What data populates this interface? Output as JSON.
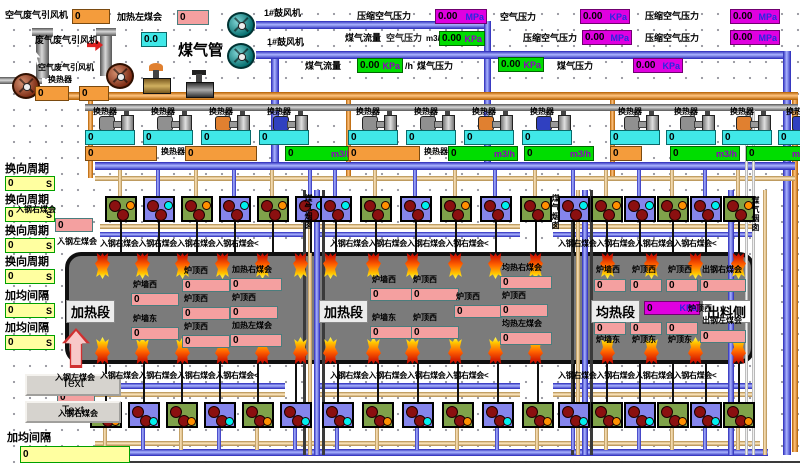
{
  "colors": {
    "magenta_box": "#E000E0",
    "green_box": "#00DD00",
    "cyan_box": "#40E8E8",
    "orange_box": "#F49C3C",
    "pink_box": "#F4A0A0",
    "yellow_box": "#FFFFA0",
    "furnace": "#7b7b7b"
  },
  "top": {
    "fan1_label": "空气废气引风机",
    "fan1_value": "0",
    "heat_left_label": "加热左煤会",
    "heat_left_value": "0",
    "blower_labels": [
      "1#鼓风机",
      "1#鼓风机"
    ],
    "row1_readouts": [
      {
        "label": "压缩空气压力",
        "value": "0.00",
        "unit": "MPa"
      },
      {
        "label": "空气压力",
        "value": "0.00",
        "unit": "KPa"
      },
      {
        "label": "压缩空气压力",
        "value": "0.00",
        "unit": "MPa"
      }
    ],
    "exhaust_fan_label": "废气废气引风机",
    "exhaust_fan_value": "0.0",
    "gas_pipe_label": "煤气管",
    "gas_flow_label": "煤气流量",
    "gas_flow_overlay": "空气压力",
    "gas_flow_overlay2": "m3/",
    "gas_flow_value": "0.00",
    "gas_flow_unit": "KPa",
    "row2_readouts": [
      {
        "label": "压缩空气压力",
        "value": "0.00",
        "unit": "MPa"
      },
      {
        "label": "压缩空气压力",
        "value": "0.00",
        "unit": "MPa"
      }
    ],
    "fan2_label": "空气废气引风机",
    "fan2_sub": "换热器",
    "row3": {
      "gas_flow_label": "煤气流量",
      "gas_flow_value": "0.00",
      "gas_flow_unit": "KPa",
      "per_hour": "/h",
      "gas_pressure_a_label": "煤气压力",
      "gas_pressure_a_value": "0.00",
      "gas_pressure_a_unit": "KPa",
      "gas_pressure_b_label": "煤气压力",
      "gas_pressure_b_value": "0.00",
      "gas_pressure_b_unit": "KPa"
    },
    "left_fan_values": [
      "0",
      "0"
    ]
  },
  "valve_row": {
    "unit_label": "换热器",
    "groups": [
      {
        "cyan_values": [
          "0",
          "0",
          "0",
          "0"
        ],
        "bottom": [
          {
            "type": "orange",
            "value": "0"
          },
          {
            "type": "orange",
            "value": "0"
          },
          {
            "type": "flow",
            "value": "0",
            "unit": "m3/h"
          }
        ]
      },
      {
        "cyan_values": [
          "0",
          "0",
          "0",
          "0"
        ],
        "bottom": [
          {
            "type": "orange",
            "value": "0"
          },
          {
            "type": "flow",
            "value": "0",
            "unit": "m3/h"
          },
          {
            "type": "flow",
            "value": "0",
            "unit": "m3/h"
          }
        ]
      },
      {
        "cyan_values": [
          "0",
          "0",
          "0",
          "0"
        ],
        "bottom": [
          {
            "type": "orange",
            "value": "0"
          },
          {
            "type": "flow",
            "value": "0",
            "unit": "m3/h"
          },
          {
            "type": "flow",
            "value": "0",
            "unit": "m3/h"
          }
        ]
      }
    ]
  },
  "sidebar": {
    "items": [
      {
        "label": "换向周期",
        "value": "0",
        "unit": "S"
      },
      {
        "label": "换向周期",
        "value": "0",
        "unit": "S"
      },
      {
        "label": "换向周期",
        "value": "0",
        "unit": "S"
      },
      {
        "label": "换向周期",
        "value": "0",
        "unit": "S"
      },
      {
        "label": "加均间隔",
        "value": "0",
        "unit": "S"
      },
      {
        "label": "加均间隔",
        "value": "0",
        "unit": "S"
      }
    ],
    "bottom_label": "加均间隔",
    "bottom_value": "0"
  },
  "buttons": [
    "Text",
    "Text"
  ],
  "burner_area": {
    "chain_text": "入钢右煤会入钢右煤会入钢右煤会入钢右煤会<",
    "left_top_label": "入钢右煤会",
    "left_top_value": "0",
    "left_top_label2": "入钢左煤会",
    "left_bottom_label": "入钢左煤会",
    "left_bottom_value": "0",
    "left_bottom_label2": "入钢右煤会",
    "stack_label": "煤气烟囱"
  },
  "furnace": {
    "sections": [
      {
        "name": "加热段",
        "boxes": [
          {
            "label": "炉墙西",
            "value": "0"
          },
          {
            "label": "炉墙东",
            "value": "0"
          },
          {
            "label": "炉顶西",
            "value": "0"
          },
          {
            "label": "炉顶西",
            "value": "0"
          },
          {
            "label": "炉顶西",
            "value": "0"
          },
          {
            "label": "加热右煤会",
            "value": "0"
          },
          {
            "label": "炉顶西",
            "value": "0"
          },
          {
            "label": "加热左煤会",
            "value": "0"
          }
        ]
      },
      {
        "name": "加热段",
        "boxes": [
          {
            "label": "炉墙西",
            "value": "0"
          },
          {
            "label": "炉墙东",
            "value": "0"
          },
          {
            "label": "炉顶西",
            "value": "0"
          },
          {
            "label": "炉顶西",
            "value": "0"
          },
          {
            "label": "炉顶西",
            "value": "0"
          },
          {
            "label": "均热右煤会",
            "value": "0"
          },
          {
            "label": "炉顶西",
            "value": "0"
          },
          {
            "label": "均热左煤会",
            "value": "0"
          }
        ]
      },
      {
        "name": "均热段",
        "pressure": {
          "value": "0",
          "unit": "KPa"
        },
        "discharge_label": "出料侧",
        "boxes": [
          {
            "label": "炉墙西",
            "value": "0"
          },
          {
            "label": "炉顶西",
            "value": "0"
          },
          {
            "label": "炉顶西",
            "value": "0"
          },
          {
            "label": "出钢右煤会",
            "value": "0"
          },
          {
            "label": "炉墙东",
            "value": "0"
          },
          {
            "label": "炉顶东",
            "value": "0"
          },
          {
            "label": "炉顶东",
            "value": "0"
          },
          {
            "label": "出钢左煤会",
            "value": "0"
          },
          {
            "label": "炉顶西",
            "value": ""
          }
        ]
      }
    ]
  }
}
